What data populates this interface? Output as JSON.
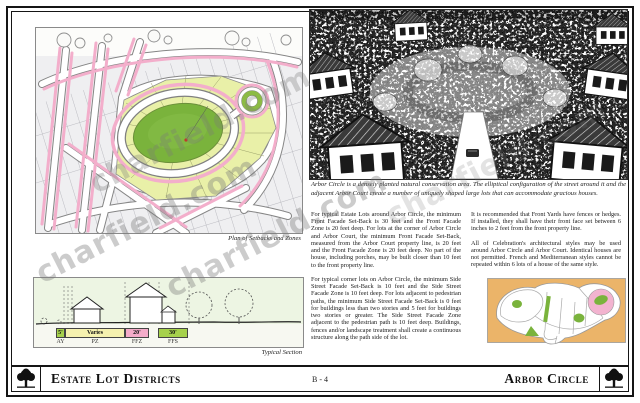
{
  "watermark": {
    "text": "charfield.com"
  },
  "plan": {
    "caption": "Plan of Setbacks and Zones"
  },
  "aerial": {
    "caption": "Arbor Circle is a densely planted natural conservation area. The elliptical configuration of the street around it and the adjacent Arbor Court create a number of uniquely shaped large lots that can accommodate gracious houses."
  },
  "body": {
    "col1": [
      "For typical Estate Lots around Arbor Circle, the minimum Front Facade Set-Back is 30 feet and the Front Facade Zone is 20 feet deep. For lots at the corner of Arbor Circle and Arbor Court, the minimum Front Facade Set-Back, measured from the Arbor Court property line, is 20 feet and the Front Facade Zone is 20 feet deep. No part of the house, including porches, may be built closer than 10 feet to the front property line.",
      "For typical corner lots on Arbor Circle, the minimum Side Street Facade Set-Back is 10 feet and the Side Street Facade Zone is 10 feet deep. For lots adjacent to pedestrian paths, the minimum Side Street Facade Set-Back is 0 feet for buildings less than two stories and 5 feet for buildings two stories or greater. The Side Street Facade Zone adjacent to the pedestrian path is 10 feet deep. Buildings, fences and/or landscape treatment shall create a continuous structure along the path side of the lot."
    ],
    "col2": [
      "It is recommended that Front Yards have fences or hedges. If installed, they shall have their front face set between 6 inches to 2 feet from the front property line.",
      "All of Celebration's architectural styles may be used around Arbor Circle and Arbor Court. Identical houses are not permitted. French and Mediterranean styles cannot be repeated within 6 lots of a house of the same style."
    ]
  },
  "section": {
    "caption": "Typical Section",
    "segments": [
      {
        "value": "5'",
        "label": "AY",
        "color": "#A6D14C"
      },
      {
        "value": "Varies",
        "label": "PZ",
        "color": "#F5F1AF"
      },
      {
        "value": "20'",
        "label": "FFZ",
        "color": "#F4ACC9"
      },
      {
        "value": "30'",
        "label": "FFS",
        "color": "#A6D14C"
      }
    ]
  },
  "footer": {
    "left_title": "Estate Lot Districts",
    "page_number": "B - 4",
    "right_title": "Arbor Circle"
  },
  "colors": {
    "zone_pink": "#F3AECB",
    "park_light": "#E9F0A8",
    "park_green": "#7AB33C",
    "locator_tan": "#EBB469",
    "locator_pink": "#F2B3CF",
    "ink": "#151515"
  }
}
